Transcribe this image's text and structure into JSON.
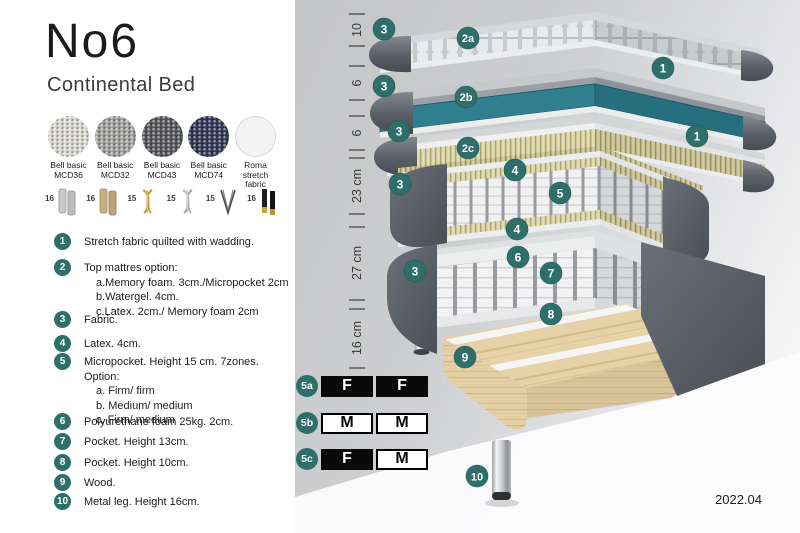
{
  "header": {
    "title": "No6",
    "subtitle": "Continental Bed"
  },
  "swatches": {
    "items": [
      {
        "line1": "Bell basic",
        "line2": "MCD36",
        "color": "#dcdad4"
      },
      {
        "line1": "Bell basic",
        "line2": "MCD32",
        "color": "#a3a2a0"
      },
      {
        "line1": "Bell basic",
        "line2": "MCD43",
        "color": "#595a5e"
      },
      {
        "line1": "Bell basic",
        "line2": "MCD74",
        "color": "#343a56"
      },
      {
        "line1": "Roma",
        "line2": "stretch fabric",
        "color": "#f3f3f3"
      }
    ]
  },
  "legs": {
    "items": [
      {
        "height": "16",
        "style": "cylinder-silver"
      },
      {
        "height": "16",
        "style": "cylinder-wood"
      },
      {
        "height": "15",
        "style": "twist-gold"
      },
      {
        "height": "15",
        "style": "twist-silver"
      },
      {
        "height": "15",
        "style": "hairpin"
      },
      {
        "height": "16",
        "style": "cone-black-gold"
      }
    ]
  },
  "legend": {
    "items": [
      {
        "num": "1",
        "text": "Stretch fabric quilted with wadding."
      },
      {
        "num": "2",
        "text": "Top mattres option:",
        "sub": [
          "a.Memory foam. 3cm./Micropocket 2cm",
          "b.Watergel. 4cm.",
          "c.Latex. 2cm./ Memory foam 2cm"
        ]
      },
      {
        "num": "3",
        "text": "Fabric."
      },
      {
        "num": "4",
        "text": "Latex. 4cm."
      },
      {
        "num": "5",
        "text": "Micropocket. Height 15 cm. 7zones. Option:",
        "sub": [
          "a. Firm/ firm",
          "b. Medium/ medium",
          "c. Firm/ medium"
        ]
      },
      {
        "num": "6",
        "text": "Polyurethane foam 25kg. 2cm."
      },
      {
        "num": "7",
        "text": "Pocket. Height 13cm."
      },
      {
        "num": "8",
        "text": "Pocket. Height 10cm."
      },
      {
        "num": "9",
        "text": "Wood."
      },
      {
        "num": "10",
        "text": "Metal leg. Height 16cm."
      }
    ]
  },
  "diagram": {
    "measurements": [
      {
        "label": "10"
      },
      {
        "label": "6"
      },
      {
        "label": "6"
      },
      {
        "label": "23 cm"
      },
      {
        "label": "27 cm"
      },
      {
        "label": "16 cm"
      }
    ],
    "badges": [
      {
        "label": "3"
      },
      {
        "label": "2a"
      },
      {
        "label": "1"
      },
      {
        "label": "3"
      },
      {
        "label": "2b"
      },
      {
        "label": "1"
      },
      {
        "label": "3"
      },
      {
        "label": "2c"
      },
      {
        "label": "3"
      },
      {
        "label": "4"
      },
      {
        "label": "5"
      },
      {
        "label": "4"
      },
      {
        "label": "3"
      },
      {
        "label": "6"
      },
      {
        "label": "7"
      },
      {
        "label": "8"
      },
      {
        "label": "9"
      },
      {
        "label": "10"
      }
    ]
  },
  "firmness": {
    "rows": [
      {
        "label": "5a",
        "cells": [
          {
            "value": "F"
          },
          {
            "value": "F"
          }
        ]
      },
      {
        "label": "5b",
        "cells": [
          {
            "value": "M"
          },
          {
            "value": "M"
          }
        ]
      },
      {
        "label": "5c",
        "cells": [
          {
            "value": "F"
          },
          {
            "value": "M"
          }
        ]
      }
    ]
  },
  "footer": {
    "version": "2022.04"
  },
  "colors": {
    "accent": "#2e6f6c",
    "watergel": "#2f7f8f",
    "latex": "#d9d3a6",
    "wood": "#e4d0a4",
    "shell": "#5a5e66"
  }
}
